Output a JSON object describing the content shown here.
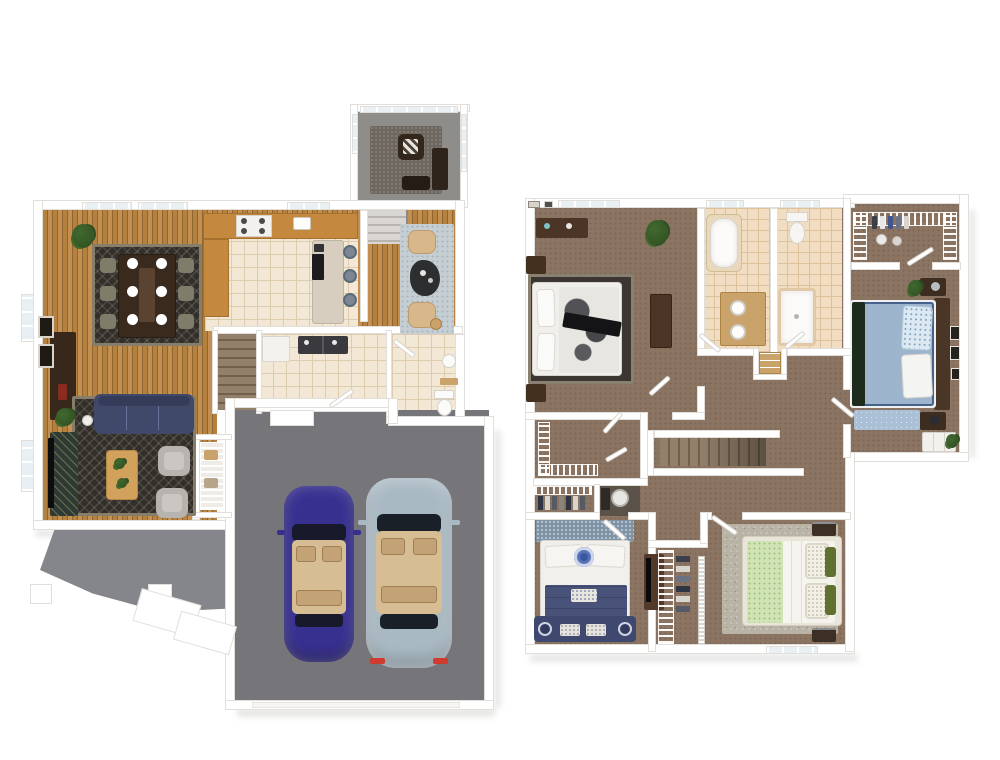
{
  "canvas": {
    "width": 1000,
    "height": 760
  },
  "scene": {
    "type": "3d-floor-plan",
    "view": "top-down-dollhouse",
    "floors": [
      {
        "id": "first-floor",
        "rooms": [
          {
            "name": "sunroom",
            "furniture": [
              "armchair",
              "chevron-pillow",
              "console-table",
              "area-rug"
            ]
          },
          {
            "name": "dining-room",
            "furniture": [
              "dining-table",
              "dining-chairs-x6",
              "place-settings-x6",
              "area-rug",
              "sideboard",
              "potted-plant",
              "wall-art-x2",
              "windows"
            ]
          },
          {
            "name": "kitchen",
            "furniture": [
              "l-counter",
              "range-cooktop",
              "sink",
              "wall-oven",
              "island",
              "bar-stools-x3"
            ]
          },
          {
            "name": "sitting-nook",
            "furniture": [
              "armchairs-x2",
              "side-table",
              "area-rug"
            ]
          },
          {
            "name": "upper-stairs",
            "furniture": [
              "staircase"
            ]
          },
          {
            "name": "main-staircase",
            "furniture": [
              "staircase"
            ]
          },
          {
            "name": "laundry-room",
            "furniture": [
              "washer-dryer",
              "cabinet"
            ]
          },
          {
            "name": "powder-room",
            "furniture": [
              "toilet",
              "pedestal-sink",
              "shelf"
            ]
          },
          {
            "name": "living-room",
            "furniture": [
              "sofa",
              "armchairs-x2",
              "coffee-table",
              "media-console",
              "tv",
              "floor-lamp",
              "area-rug",
              "potted-plant",
              "window"
            ]
          },
          {
            "name": "pantry-closet",
            "furniture": [
              "wire-shelving"
            ]
          },
          {
            "name": "garage",
            "furniture": [
              "sedan-purple",
              "sedan-silver-blue",
              "entry-step"
            ]
          },
          {
            "name": "patio",
            "furniture": [
              "posts-x2",
              "steps"
            ]
          }
        ]
      },
      {
        "id": "second-floor",
        "rooms": [
          {
            "name": "master-bedroom",
            "furniture": [
              "bed-black-white",
              "dresser",
              "nightstands-x2",
              "armoire",
              "area-rug",
              "potted-plant",
              "window"
            ]
          },
          {
            "name": "bathroom-tub",
            "furniture": [
              "bathtub",
              "double-vanity",
              "window"
            ]
          },
          {
            "name": "bathroom-shower",
            "furniture": [
              "toilet",
              "shower",
              "window"
            ]
          },
          {
            "name": "linen-closet",
            "furniture": [
              "shelves"
            ]
          },
          {
            "name": "walk-in-closet",
            "furniture": [
              "wire-shelving",
              "hanging-clothes"
            ]
          },
          {
            "name": "bedroom-blue",
            "furniture": [
              "bed-blue",
              "nightstands-x2",
              "white-dresser",
              "area-rug",
              "wall-art-x3",
              "potted-plants-x2"
            ]
          },
          {
            "name": "stairwell-hall",
            "furniture": [
              "staircase"
            ]
          },
          {
            "name": "hall-closet",
            "furniture": [
              "wire-shelving"
            ]
          },
          {
            "name": "clothes-closet",
            "furniture": [
              "wire-shelf",
              "hanging-clothes"
            ]
          },
          {
            "name": "utility-closet",
            "furniture": [
              "water-heater"
            ]
          },
          {
            "name": "bedroom-navy",
            "furniture": [
              "bed-navy-medallion",
              "storage-bench",
              "media-chest",
              "tv",
              "headboard-rug"
            ]
          },
          {
            "name": "shared-closet",
            "furniture": [
              "wire-shelving",
              "hanging-clothes",
              "louver-door"
            ]
          },
          {
            "name": "bedroom-green",
            "furniture": [
              "bed-green-white",
              "nightstands-x2",
              "area-rug",
              "window"
            ]
          }
        ]
      }
    ]
  },
  "colors": {
    "canvas-bg": "#ffffff",
    "wall": "#ffffff",
    "wall-edge": "#e2dfdb",
    "wood-a": "#b4813f",
    "wood-b": "#8f6530",
    "wood-c": "#c39052",
    "tile": "#f2e8d5",
    "tile-line": "#ddccae",
    "tile-warm": "#f0ddc2",
    "tile-warm-line": "#dcc19b",
    "counter-wood": "#c4883f",
    "island": "#d8cec0",
    "carpet": "#8b7462",
    "carpet-dot": "#7b6655",
    "sun-floor": "#8f8d89",
    "garage-floor": "#76767a",
    "patio": "#85868b",
    "stair-a": "#93806b",
    "stair-b": "#72604d",
    "stair-pale-a": "#dad6d1",
    "stair-pale-b": "#b8b4af",
    "rug-dark": "#322e2a",
    "rug-dark-border": "#877d6b",
    "rug-light": "#c5ced3",
    "rug-blue": "#a9c0d6",
    "rug-speckle": "#b8b3a5",
    "rug-texture-blue": "#7e93a5",
    "sofa-navy": "#41496b",
    "chair-gray": "#b7b3ae",
    "chair-tan": "#d8b88b",
    "chair-olive": "#7f7c6a",
    "wood-dark": "#3a2a1d",
    "wood-mid": "#55392a",
    "wood-warm": "#c9a36a",
    "white-furniture": "#f4f2ef",
    "car-purple": "#38308f",
    "car-silver": "#a9b9c3",
    "car-glass": "#181a2c",
    "car-interior": "#d6bd93",
    "taillight": "#d03b2f",
    "glass": "#e9f0f4",
    "bed-white": "#f1efeb",
    "bed-blue": "#9db4cd",
    "bed-navy": "#495379",
    "bench-navy": "#3f486e",
    "bed-green": "#cfe3b4",
    "pillow-olive": "#5f7030",
    "throw-dark": "#141417",
    "plant-green": "#41692f",
    "plant-dark": "#2e4d20",
    "appliance-dark": "#3a3a3e",
    "heater-metal": "#e8e7e4"
  }
}
